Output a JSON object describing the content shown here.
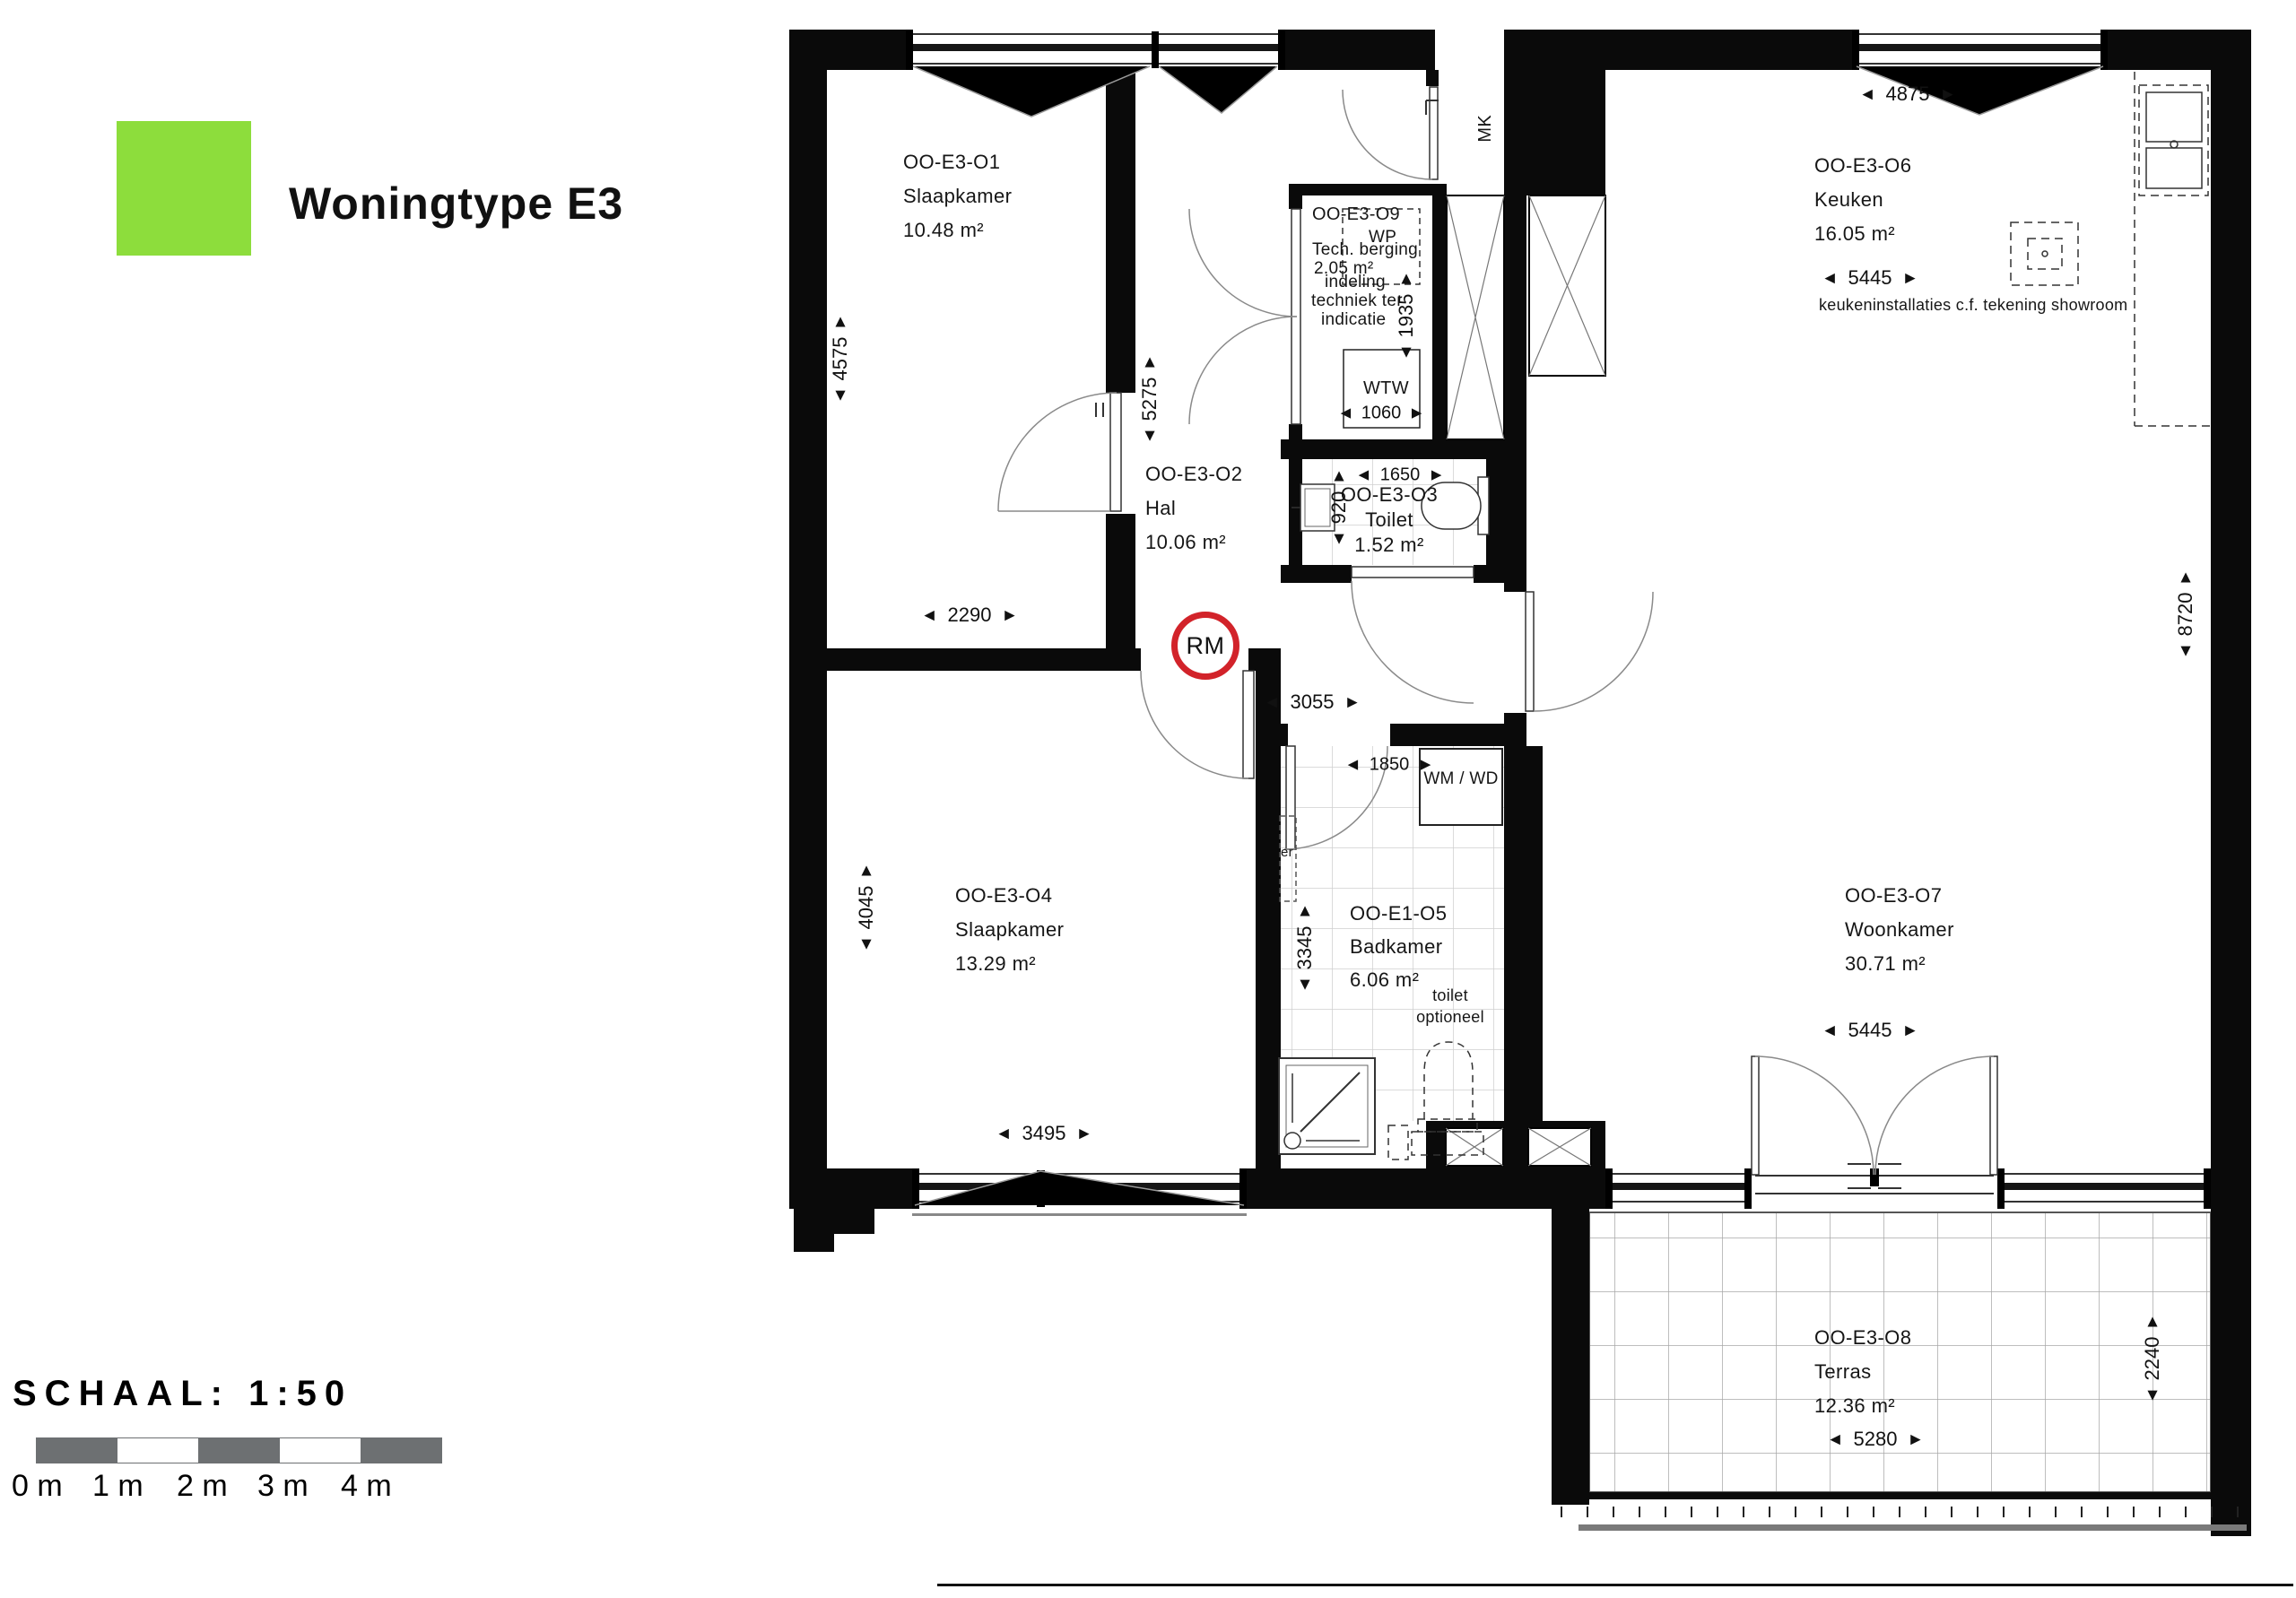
{
  "legend": {
    "title": "Woningtype E3",
    "swatch_color": "#8ddd3c"
  },
  "scale": {
    "label": "SCHAAL: 1:50",
    "ticks": [
      "0 m",
      "1 m",
      "2 m",
      "3 m",
      "4 m"
    ],
    "bar_color": "#6d7072"
  },
  "icons": {
    "left": "◄",
    "right": "►",
    "up": "▲",
    "down": "▼"
  },
  "rooms": {
    "slaapkamer1": {
      "code": "OO-E3-O1",
      "name": "Slaapkamer",
      "area": "10.48 m²"
    },
    "hal": {
      "code": "OO-E3-O2",
      "name": "Hal",
      "area": "10.06 m²"
    },
    "toilet": {
      "code": "OO-E3-O3",
      "name": "Toilet",
      "area": "1.52 m²"
    },
    "slaapkamer2": {
      "code": "OO-E3-O4",
      "name": "Slaapkamer",
      "area": "13.29 m²"
    },
    "badkamer": {
      "code": "OO-E1-O5",
      "name": "Badkamer",
      "area": "6.06 m²"
    },
    "keuken": {
      "code": "OO-E3-O6",
      "name": "Keuken",
      "area": "16.05 m²"
    },
    "woonkamer": {
      "code": "OO-E3-O7",
      "name": "Woonkamer",
      "area": "30.71 m²"
    },
    "terras": {
      "code": "OO-E3-O8",
      "name": "Terras",
      "area": "12.36 m²"
    },
    "techberging": {
      "code": "OO-E3-O9",
      "name": "Tech. berging",
      "area": "2.05 m²"
    }
  },
  "annotations": {
    "wp": "WP",
    "wtw": "WTW",
    "mk": "MK",
    "wmwd": "WM / WD",
    "rm": "RM",
    "rm_color": "#d2232a",
    "indeling_1": "indeling",
    "indeling_2": "techniek ter",
    "indeling_3": "indicatie",
    "toilet_opt_1": "toilet",
    "toilet_opt_2": "optioneel",
    "er": "er",
    "keuken_note": "keukeninstallaties c.f. tekening showroom"
  },
  "dimensions": {
    "slaap1_height": "4575",
    "slaap1_width": "2290",
    "hal_height": "5275",
    "tech_height": "1935",
    "wtw_width": "1060",
    "toilet_width": "1650",
    "toilet_height": "920",
    "hal_width": "3055",
    "slaap2_height": "4045",
    "slaap2_width": "3495",
    "badkamer_width": "1850",
    "badkamer_height": "3345",
    "keuken_top": "4875",
    "keuken_width": "5445",
    "right_height": "8720",
    "woonkamer_width": "5445",
    "terras_width": "5280",
    "terras_height": "2240"
  }
}
